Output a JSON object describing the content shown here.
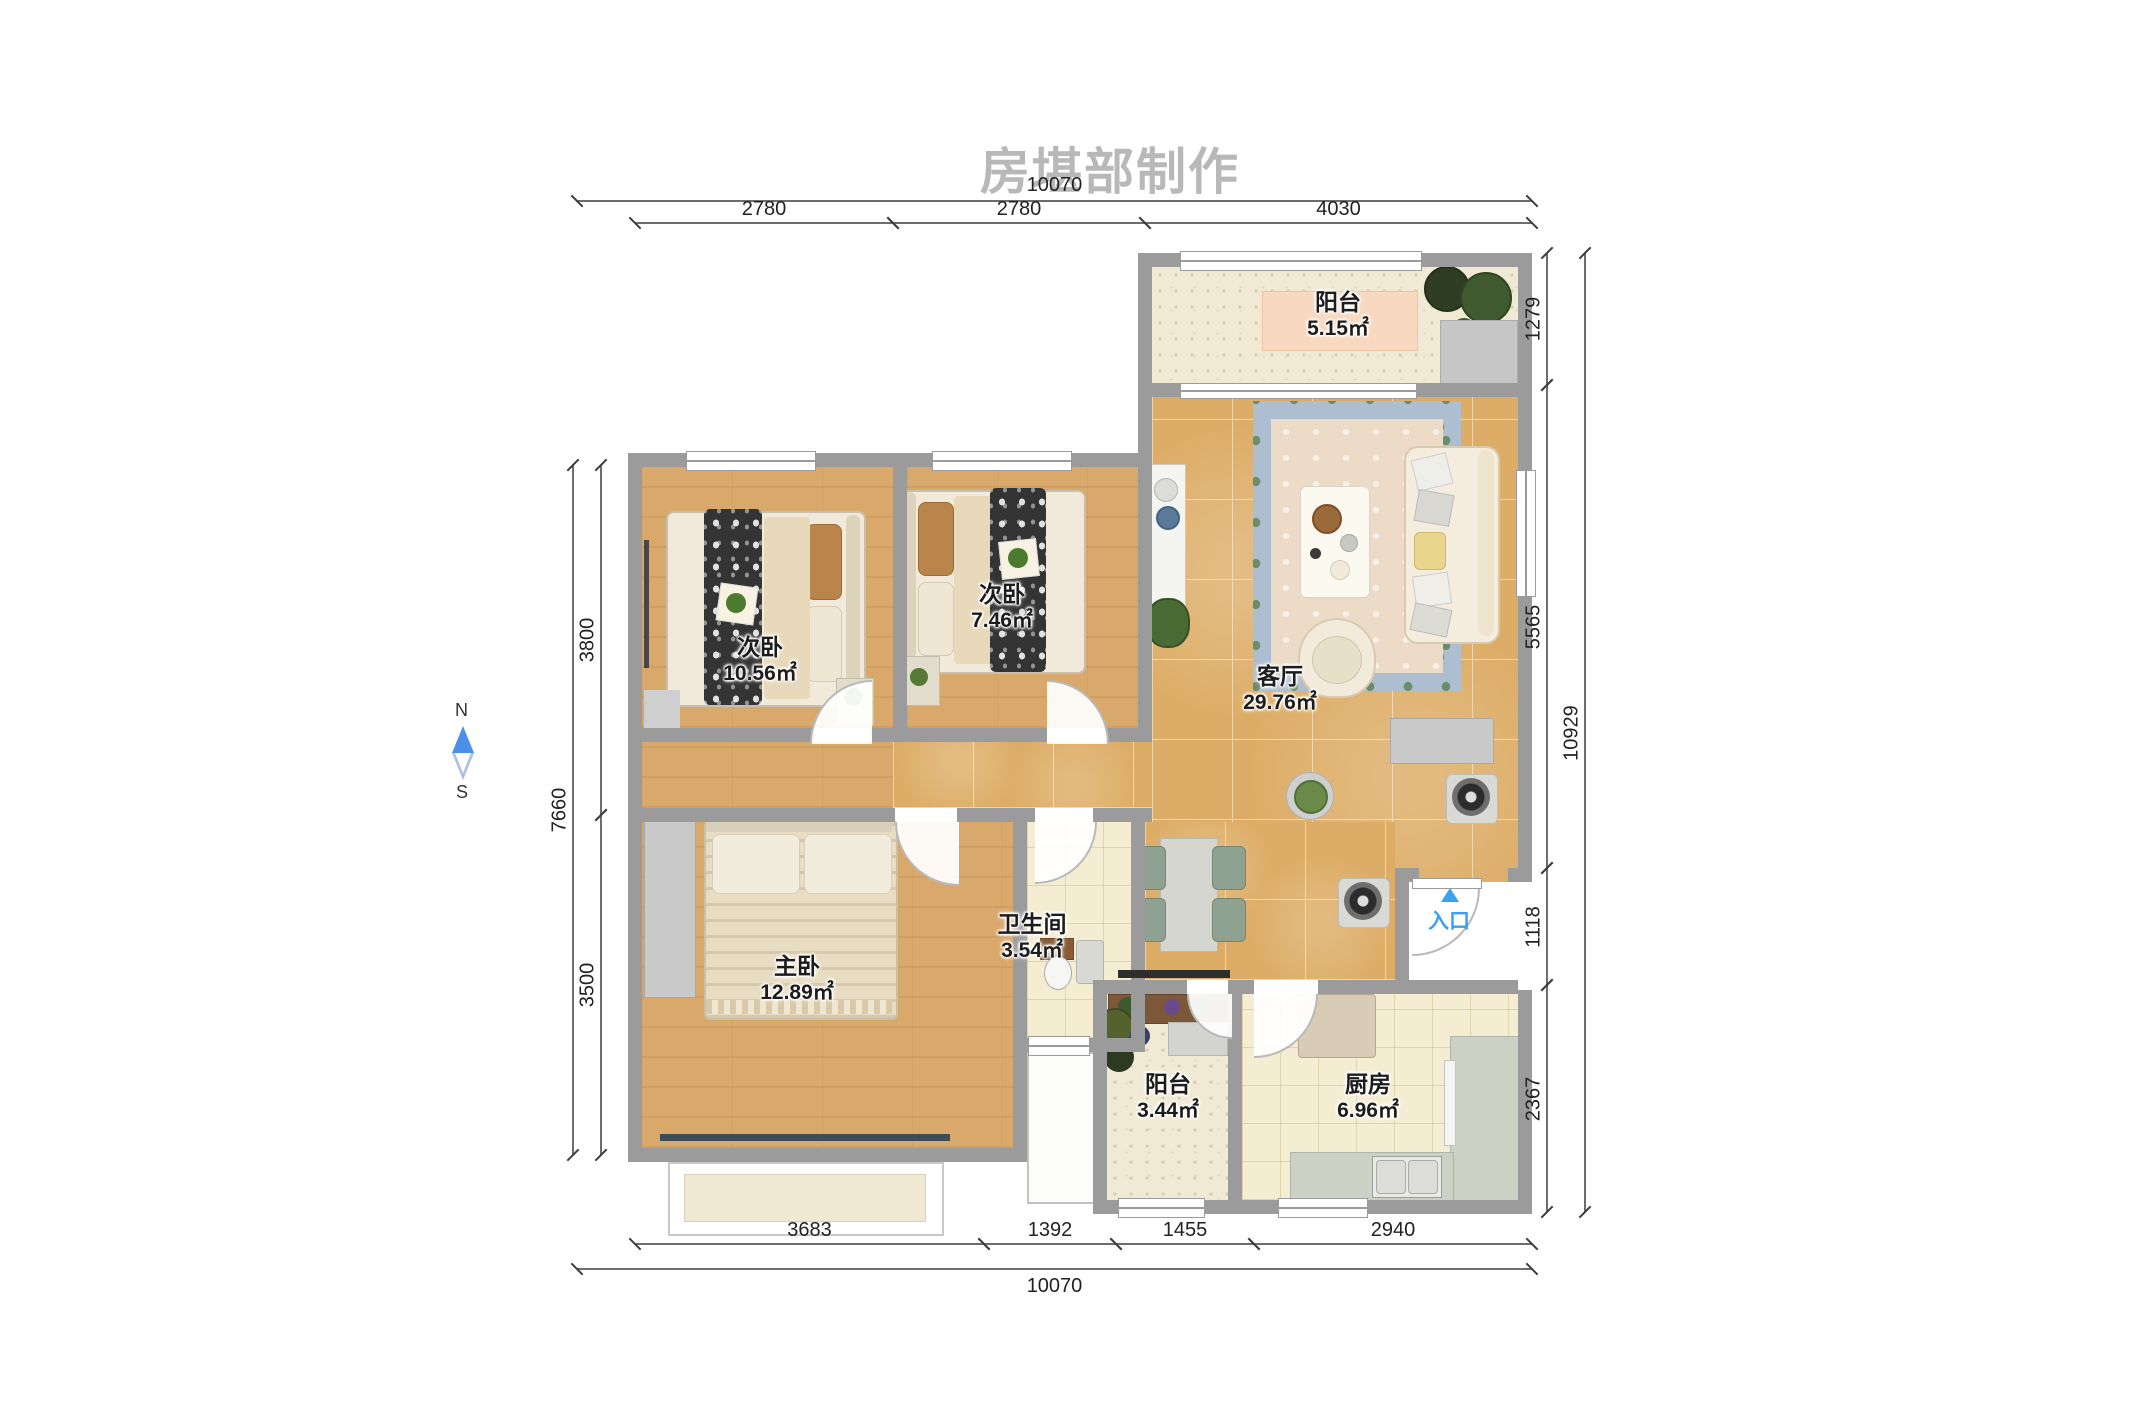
{
  "title": "房堪部制作",
  "compass": {
    "north": "N",
    "south": "S"
  },
  "entrance": {
    "label": "入口"
  },
  "rooms": [
    {
      "name": "阳台",
      "area": "5.15㎡"
    },
    {
      "name": "次卧",
      "area": "10.56㎡"
    },
    {
      "name": "次卧",
      "area": "7.46㎡"
    },
    {
      "name": "客厅",
      "area": "29.76㎡"
    },
    {
      "name": "主卧",
      "area": "12.89㎡"
    },
    {
      "name": "卫生间",
      "area": "3.54㎡"
    },
    {
      "name": "阳台",
      "area": "3.44㎡"
    },
    {
      "name": "厨房",
      "area": "6.96㎡"
    }
  ],
  "dimensions": {
    "top": {
      "total": "10070",
      "segments": [
        "2780",
        "2780",
        "4030"
      ]
    },
    "bottom": {
      "total": "10070",
      "segments": [
        "3683",
        "1392",
        "1455",
        "2940"
      ]
    },
    "left": {
      "total": "7660",
      "segments": [
        "3800",
        "3500"
      ]
    },
    "right": {
      "total": "10929",
      "segments": [
        "1279",
        "5565",
        "1118",
        "2367"
      ]
    }
  },
  "colors": {
    "accent_blue": "#3aa0f0",
    "wall_gray": "#9b9b9b",
    "wood_floor": "#d9a96c",
    "gold_tile": "#ddad67",
    "cream_tile": "#f5edd1"
  }
}
